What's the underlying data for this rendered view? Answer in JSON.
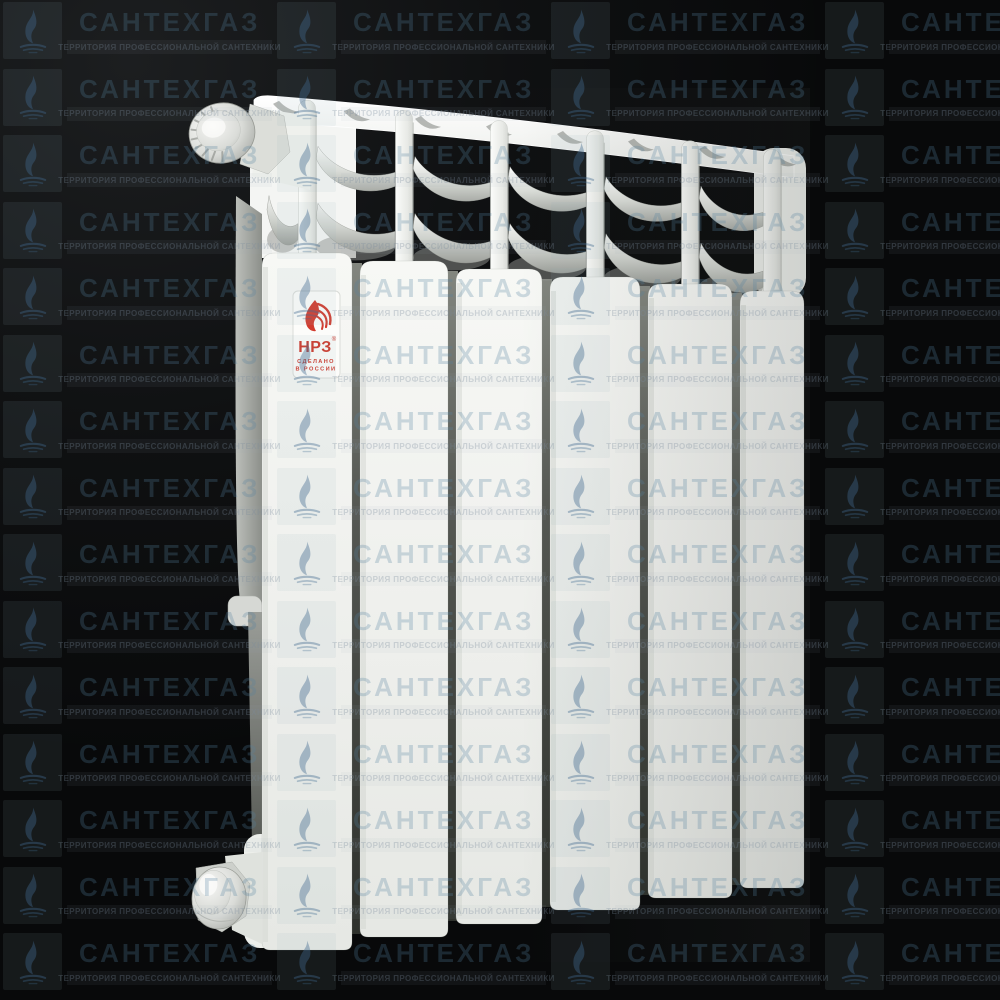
{
  "background": {
    "color": "#08090a"
  },
  "watermark": {
    "title": "САНТЕХГАЗ",
    "subtitle": "ТЕРРИТОРИЯ ПРОФЕССИОНАЛЬНОЙ САНТЕХНИКИ",
    "tile_icon": "gas-flame-icon",
    "title_color": "#5680a0",
    "grid": {
      "cols": 4,
      "rows": 15
    }
  },
  "product_image": {
    "subject": "bimetal heating radiator",
    "sections_visible": 6
  },
  "radiator_label": {
    "brand": "НРЗ",
    "reg_mark": "®",
    "made_in_line1": "СДЕЛАНО",
    "made_in_line2": "В РОССИИ",
    "brand_color": "#cf372a",
    "logo_icon": "flame-wing-icon"
  }
}
